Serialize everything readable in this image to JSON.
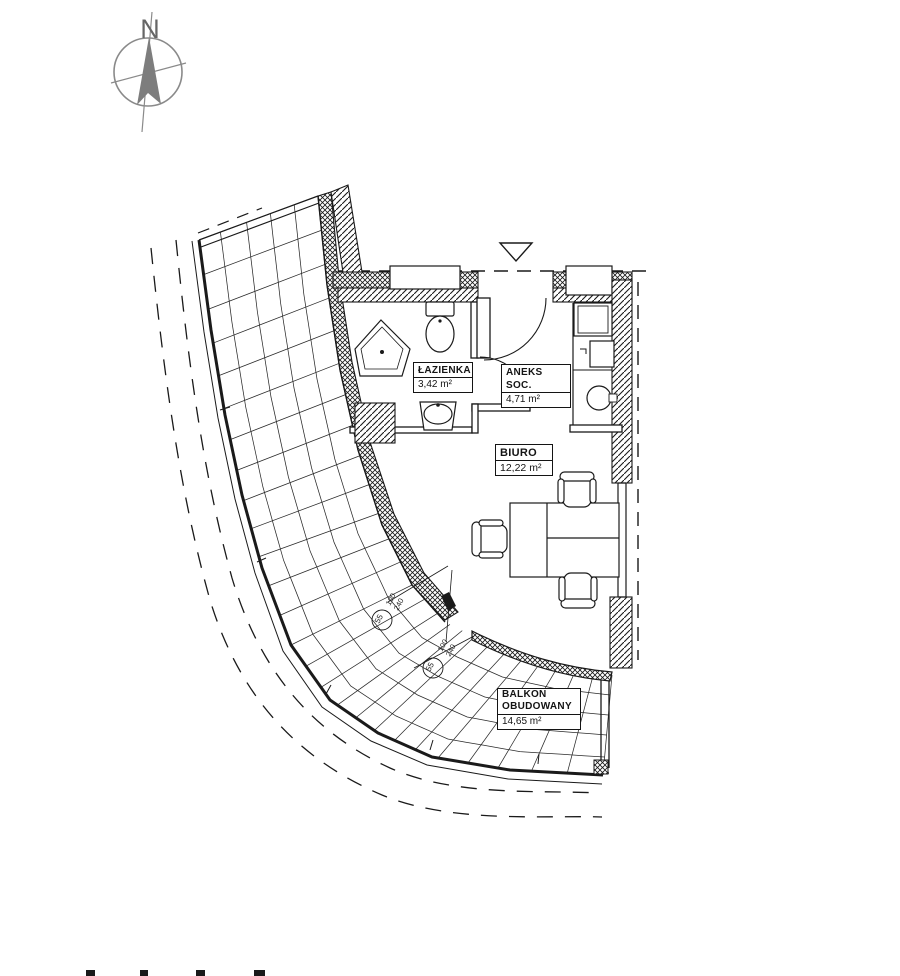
{
  "compass": {
    "label": "N"
  },
  "entrance": {
    "icon": "entrance-triangle-icon"
  },
  "rooms": [
    {
      "name": "ŁAZIENKA",
      "area": "3,42 m²"
    },
    {
      "name": "ANEKS SOC.",
      "area": "4,71 m²"
    },
    {
      "name": "BIURO",
      "area": "12,22 m²"
    },
    {
      "name1": "BALKON",
      "name2": "OBUDOWANY",
      "area": "14,65 m²"
    }
  ],
  "window_markers": [
    {
      "width": "100",
      "height": "240",
      "ref": "55"
    },
    {
      "width": "100",
      "height": "240",
      "ref": "55"
    }
  ],
  "colors": {
    "line": "#1a1a1a",
    "compass_gray": "#8a8a8a",
    "background": "#ffffff"
  }
}
